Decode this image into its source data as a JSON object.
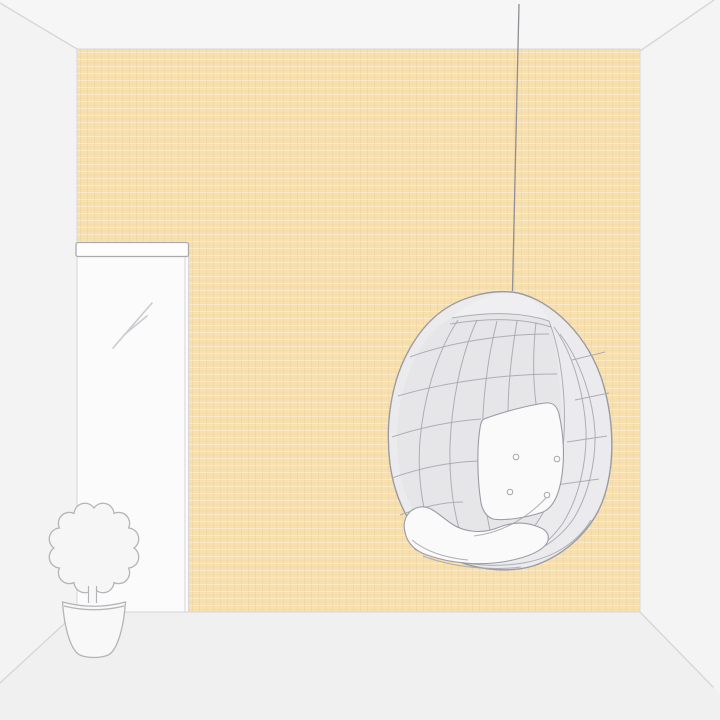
{
  "scene": {
    "kind": "room-illustration",
    "labels": {
      "room": "minimal room interior in perspective",
      "ceiling": "ceiling",
      "left_wall": "left side wall",
      "right_wall": "right side wall",
      "floor": "floor",
      "wall": "peach linen wallpaper back wall",
      "mirror": "tall white framed mirror",
      "mirror_frame": "mirror top frame bar",
      "reflection": "glass reflection strokes",
      "plant": "potted plant with round clipped foliage",
      "foliage": "scalloped round foliage",
      "trunk": "plant trunk",
      "pot": "plant pot",
      "chair": "hanging egg chair",
      "cord": "hanging cord",
      "back_cushion": "white tufted back cushion",
      "seat_cushion": "white seat cushion"
    }
  },
  "colors": {
    "bg-ceiling": "#f6f6f7",
    "bg-left": "#f3f3f4",
    "bg-right": "#f4f4f5",
    "bg-floor": "#f0f0f1",
    "room-line": "#d7d7da",
    "wall": "#f8dfae",
    "mirror": "#fbfbfc",
    "frame": "#fdfdfe",
    "frame-line": "#ababaf",
    "soft-line": "#d6d6d9",
    "reflect": "#cbcbd0",
    "outline": "#b4b4b8",
    "plant-fill": "#f6f6f7",
    "pot-fill": "#f8f8f9",
    "chair-fill": "#ebebee",
    "chair-shade": "#e6e6e9",
    "chair-cap": "#efeff1",
    "chair-outline": "#9b9ba3",
    "chair-line": "#a6a6ae",
    "cushion": "#fafafb",
    "cord": "#8e8e94"
  }
}
